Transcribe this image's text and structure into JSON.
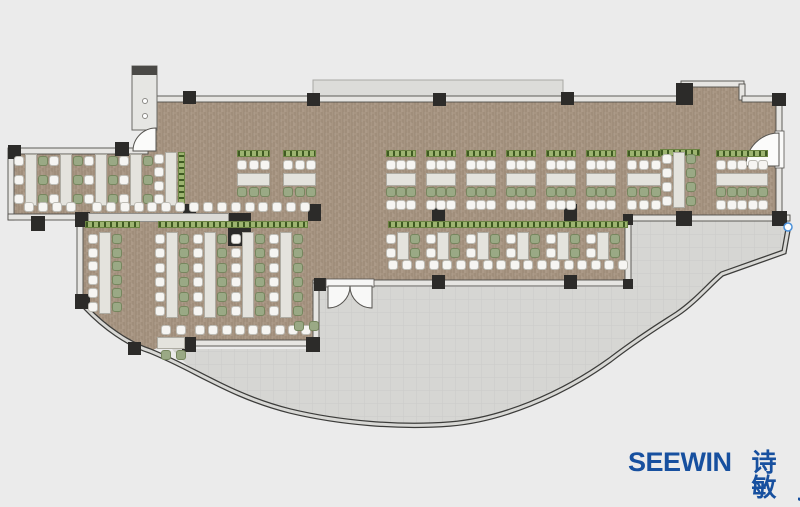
{
  "page": {
    "background": "#ebebeb"
  },
  "logo": {
    "brand": "SEEWIN",
    "cjk": "诗敏",
    "color": "#17509f"
  },
  "palette": {
    "floor": "#a79582",
    "terrace": "#d6d6d3",
    "deck": "#dcdcd9",
    "wall_fill": "#e6e5e2",
    "wall_stroke": "#504e4a",
    "column": "#2c2b29",
    "table": "#e4e3dd",
    "table_border": "#aeaca3",
    "chair_white": "#f6f5f2",
    "chair_white_border": "#bdbcb5",
    "chair_green": "#9aa985",
    "chair_green_border": "#76865e",
    "planter": "#9db470",
    "planter_border": "#6b8342",
    "planter_dot": "#3f5a22",
    "counter": "#dbdad6",
    "facade_dark": "#3c3c3a",
    "facade_light": "#d8d8d5",
    "marker_blue": "#4a90d9"
  },
  "floorplan": {
    "walls": [
      [
        148,
        96,
        537,
        6
      ],
      [
        681,
        81,
        63,
        6
      ],
      [
        739,
        84,
        6,
        16
      ],
      [
        742,
        96,
        40,
        6
      ],
      [
        776,
        100,
        6,
        35
      ],
      [
        776,
        166,
        6,
        54
      ],
      [
        12,
        148,
        136,
        6
      ],
      [
        8,
        148,
        6,
        72
      ],
      [
        8,
        214,
        76,
        6
      ],
      [
        77,
        218,
        6,
        86
      ],
      [
        625,
        215,
        165,
        6
      ],
      [
        625,
        218,
        6,
        67
      ],
      [
        313,
        280,
        17,
        6
      ],
      [
        370,
        280,
        260,
        6
      ],
      [
        313,
        283,
        6,
        62
      ],
      [
        166,
        340,
        152,
        6
      ]
    ],
    "columns": [
      [
        183,
        91,
        13,
        13
      ],
      [
        307,
        93,
        13,
        13
      ],
      [
        433,
        93,
        13,
        13
      ],
      [
        561,
        92,
        13,
        13
      ],
      [
        676,
        83,
        17,
        22
      ],
      [
        772,
        93,
        14,
        13
      ],
      [
        8,
        145,
        13,
        14
      ],
      [
        115,
        142,
        14,
        14
      ],
      [
        31,
        216,
        14,
        15
      ],
      [
        75,
        212,
        15,
        15
      ],
      [
        75,
        294,
        15,
        15
      ],
      [
        183,
        204,
        13,
        17
      ],
      [
        308,
        204,
        13,
        17
      ],
      [
        432,
        204,
        13,
        17
      ],
      [
        564,
        204,
        13,
        17
      ],
      [
        228,
        213,
        23,
        33
      ],
      [
        676,
        211,
        16,
        15
      ],
      [
        772,
        211,
        15,
        15
      ],
      [
        623,
        214,
        10,
        11
      ],
      [
        432,
        275,
        13,
        14
      ],
      [
        564,
        275,
        13,
        14
      ],
      [
        623,
        279,
        10,
        10
      ],
      [
        314,
        278,
        12,
        13
      ],
      [
        182,
        337,
        14,
        15
      ],
      [
        306,
        337,
        14,
        15
      ],
      [
        128,
        342,
        13,
        13
      ]
    ],
    "furniture": [
      {
        "t": "vu",
        "x": 14,
        "y": 154,
        "h": 52
      },
      {
        "t": "vu",
        "x": 49,
        "y": 154,
        "h": 52
      },
      {
        "t": "vu",
        "x": 84,
        "y": 154,
        "h": 52
      },
      {
        "t": "vu",
        "x": 119,
        "y": 154,
        "h": 52
      },
      {
        "t": "vu",
        "x": 154,
        "y": 152,
        "h": 54,
        "right": "planter"
      },
      {
        "t": "pl",
        "x": 660,
        "y": 149,
        "w": 40
      },
      {
        "t": "vu",
        "x": 662,
        "y": 152,
        "h": 56
      },
      {
        "t": "hg",
        "x": 237,
        "y": 150,
        "w": 33,
        "rows": "pwtg"
      },
      {
        "t": "hg",
        "x": 283,
        "y": 150,
        "w": 33,
        "rows": "pwtg"
      },
      {
        "t": "hg",
        "x": 386,
        "y": 150,
        "w": 30,
        "rows": "pwtgw"
      },
      {
        "t": "hg",
        "x": 426,
        "y": 150,
        "w": 30,
        "rows": "pwtgw"
      },
      {
        "t": "hg",
        "x": 466,
        "y": 150,
        "w": 30,
        "rows": "pwtgw"
      },
      {
        "t": "hg",
        "x": 506,
        "y": 150,
        "w": 30,
        "rows": "pwtgw"
      },
      {
        "t": "hg",
        "x": 546,
        "y": 150,
        "w": 30,
        "rows": "pwtgw"
      },
      {
        "t": "hg",
        "x": 586,
        "y": 150,
        "w": 30,
        "rows": "pwtgw"
      },
      {
        "t": "hg",
        "x": 627,
        "y": 150,
        "w": 34,
        "rows": "pwtgw"
      },
      {
        "t": "hg",
        "x": 716,
        "y": 150,
        "w": 52,
        "rows": "pwtgw"
      },
      {
        "t": "cr",
        "x": 24,
        "y": 202,
        "w": 52,
        "c": "w"
      },
      {
        "t": "cr",
        "x": 92,
        "y": 202,
        "w": 218,
        "c": "w"
      },
      {
        "t": "ct",
        "x": 88,
        "y": 213,
        "w": 141,
        "h": 9
      },
      {
        "t": "pl",
        "x": 85,
        "y": 221,
        "w": 55
      },
      {
        "t": "pl",
        "x": 158,
        "y": 221,
        "w": 150
      },
      {
        "t": "pl",
        "x": 388,
        "y": 221,
        "w": 240
      },
      {
        "t": "vu",
        "x": 88,
        "y": 232,
        "h": 82
      },
      {
        "t": "vu",
        "x": 155,
        "y": 232,
        "h": 86
      },
      {
        "t": "vu",
        "x": 193,
        "y": 232,
        "h": 86
      },
      {
        "t": "vu",
        "x": 231,
        "y": 232,
        "h": 86
      },
      {
        "t": "vu",
        "x": 269,
        "y": 232,
        "h": 86
      },
      {
        "t": "vu",
        "x": 386,
        "y": 232,
        "h": 28
      },
      {
        "t": "vu",
        "x": 426,
        "y": 232,
        "h": 28
      },
      {
        "t": "vu",
        "x": 466,
        "y": 232,
        "h": 28
      },
      {
        "t": "vu",
        "x": 506,
        "y": 232,
        "h": 28
      },
      {
        "t": "vu",
        "x": 546,
        "y": 232,
        "h": 28
      },
      {
        "t": "vu",
        "x": 586,
        "y": 232,
        "h": 28
      },
      {
        "t": "cr",
        "x": 388,
        "y": 260,
        "w": 240,
        "c": "w"
      },
      {
        "t": "cr",
        "x": 195,
        "y": 325,
        "w": 116,
        "c": "w"
      },
      {
        "t": "cr",
        "x": 161,
        "y": 325,
        "w": 25,
        "c": "w"
      },
      {
        "t": "tb",
        "x": 157,
        "y": 337,
        "w": 28,
        "h": 12
      },
      {
        "t": "cr",
        "x": 161,
        "y": 350,
        "w": 25,
        "c": "g"
      },
      {
        "t": "cr",
        "x": 294,
        "y": 321,
        "w": 25,
        "c": "g"
      }
    ]
  }
}
